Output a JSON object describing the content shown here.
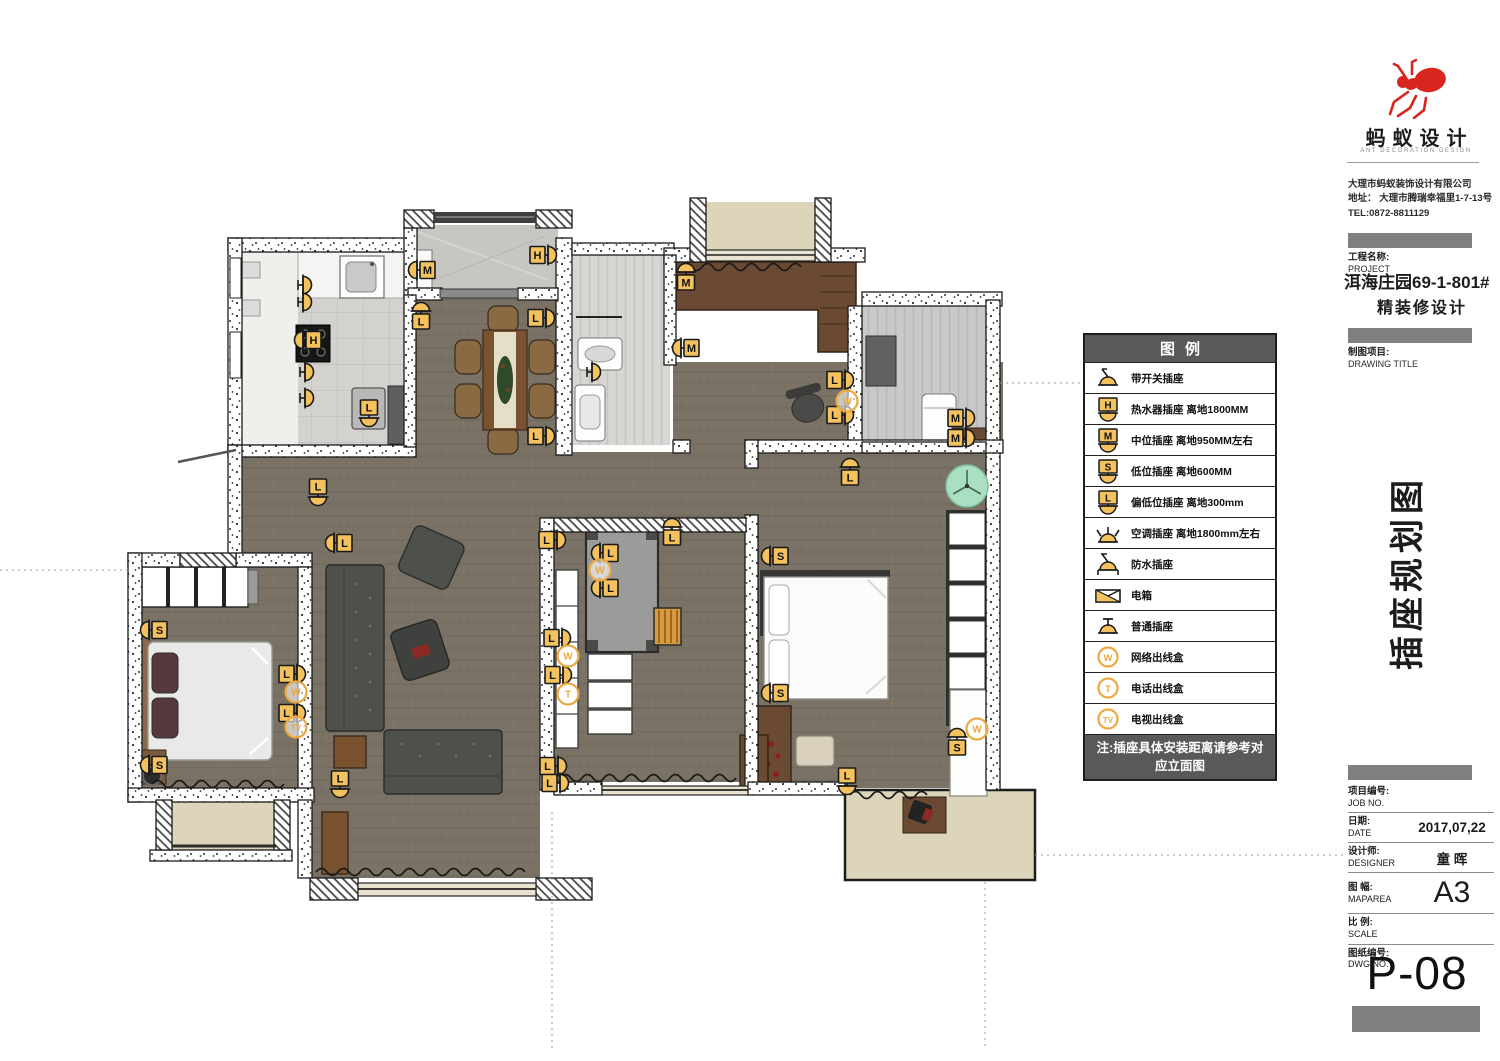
{
  "colors": {
    "accent_yellow": "#f3c25e",
    "outlet_orange": "#eca93f",
    "legend_header_bg": "#58595b",
    "brand_red": "#d9251d",
    "wood_floor": "#7b7266",
    "balcony_floor": "#ddd5b9",
    "left_bar_gray": "#737373"
  },
  "brand": {
    "name": "蚂蚁设计",
    "subtitle": "ANT DECORATION DESIGN",
    "company": "大理市蚂蚁装饰设计有限公司",
    "address": "地址： 大理市腾瑞幸福里1-7-13号",
    "tel": "TEL:0872-8811129"
  },
  "project": {
    "label_cn": "工程名称:",
    "label_en": "PROJECT",
    "name_line1": "洱海庄园69-1-801#",
    "name_line2": "精装修设计"
  },
  "drawing": {
    "label_cn": "制图项目:",
    "label_en": "DRAWING TITLE",
    "vertical_title": "插座规划图"
  },
  "legend": {
    "title": "图例",
    "items": [
      {
        "icon": "switch-socket",
        "label": "带开关插座"
      },
      {
        "icon": "letter-socket",
        "letter": "H",
        "label": "热水器插座 离地1800MM"
      },
      {
        "icon": "letter-socket",
        "letter": "M",
        "label": "中位插座  离地950MM左右"
      },
      {
        "icon": "letter-socket",
        "letter": "S",
        "label": "低位插座  离地600MM"
      },
      {
        "icon": "letter-socket",
        "letter": "L",
        "label": "偏低位插座 离地300mm"
      },
      {
        "icon": "ac-socket",
        "label": "空调插座 离地1800mm左右"
      },
      {
        "icon": "waterproof-socket",
        "label": "防水插座"
      },
      {
        "icon": "power-box",
        "label": "电箱"
      },
      {
        "icon": "normal-socket",
        "label": "普通插座"
      },
      {
        "icon": "circle-outlet",
        "letter": "W",
        "label": "网络出线盒"
      },
      {
        "icon": "circle-outlet",
        "letter": "T",
        "label": "电话出线盒"
      },
      {
        "icon": "circle-outlet",
        "letter": "TV",
        "label": "电视出线盒"
      }
    ],
    "note": "注:插座具体安装距离请参考对应立面图"
  },
  "titleblock": {
    "rows": [
      {
        "cn": "项目编号:",
        "en": "JOB NO.",
        "value": ""
      },
      {
        "cn": "日期:",
        "en": "DATE",
        "value": "2017,07,22"
      },
      {
        "cn": "设计师:",
        "en": "DESIGNER",
        "value": "童 晖"
      },
      {
        "cn": "图 幅:",
        "en": "MAPAREA",
        "value": "A3",
        "big": true
      },
      {
        "cn": "比 例:",
        "en": "SCALE",
        "value": ""
      },
      {
        "cn": "图纸编号:",
        "en": "DWG NO.",
        "value": ""
      }
    ],
    "sheet_no": "P-08"
  },
  "plan": {
    "sockets": [
      {
        "x": 303,
        "y": 285,
        "rot": 90
      },
      {
        "x": 303,
        "y": 302,
        "rot": 90
      },
      {
        "x": 303,
        "y": 340,
        "letter": "H",
        "rot": -90
      },
      {
        "x": 305,
        "y": 372,
        "rot": 90
      },
      {
        "x": 305,
        "y": 398,
        "rot": 90
      },
      {
        "x": 369,
        "y": 418,
        "letter": "L",
        "rot": 180
      },
      {
        "x": 417,
        "y": 270,
        "letter": "M",
        "rot": -90
      },
      {
        "x": 548,
        "y": 255,
        "letter": "H",
        "rot": 90
      },
      {
        "x": 421,
        "y": 311,
        "letter": "L",
        "rot": 0
      },
      {
        "x": 546,
        "y": 318,
        "letter": "L",
        "rot": 90
      },
      {
        "x": 546,
        "y": 436,
        "letter": "L",
        "rot": 90
      },
      {
        "x": 318,
        "y": 497,
        "letter": "L",
        "rot": 180
      },
      {
        "x": 592,
        "y": 372,
        "rot": 90
      },
      {
        "x": 686,
        "y": 272,
        "letter": "M",
        "rot": 0
      },
      {
        "x": 681,
        "y": 348,
        "letter": "M",
        "rot": -90
      },
      {
        "x": 845,
        "y": 380,
        "letter": "L",
        "rot": 90
      },
      {
        "x": 845,
        "y": 415,
        "letter": "L",
        "rot": 90
      },
      {
        "x": 966,
        "y": 418,
        "letter": "M",
        "rot": 90
      },
      {
        "x": 966,
        "y": 438,
        "letter": "M",
        "rot": 90
      },
      {
        "x": 850,
        "y": 467,
        "letter": "L",
        "rot": 0
      },
      {
        "x": 770,
        "y": 556,
        "letter": "S",
        "rot": -90
      },
      {
        "x": 770,
        "y": 693,
        "letter": "S",
        "rot": -90
      },
      {
        "x": 847,
        "y": 786,
        "letter": "L",
        "rot": 180
      },
      {
        "x": 957,
        "y": 737,
        "letter": "S",
        "rot": 0
      },
      {
        "x": 334,
        "y": 543,
        "letter": "L",
        "rot": -90
      },
      {
        "x": 557,
        "y": 540,
        "letter": "L",
        "rot": 90
      },
      {
        "x": 600,
        "y": 553,
        "letter": "L",
        "rot": -90
      },
      {
        "x": 600,
        "y": 588,
        "letter": "L",
        "rot": -90
      },
      {
        "x": 672,
        "y": 527,
        "letter": "L",
        "rot": 0
      },
      {
        "x": 562,
        "y": 638,
        "letter": "L",
        "rot": 90
      },
      {
        "x": 563,
        "y": 675,
        "letter": "L",
        "rot": 90
      },
      {
        "x": 558,
        "y": 766,
        "letter": "L",
        "rot": 90
      },
      {
        "x": 560,
        "y": 783,
        "letter": "L",
        "rot": 90
      },
      {
        "x": 149,
        "y": 630,
        "letter": "S",
        "rot": -90
      },
      {
        "x": 149,
        "y": 765,
        "letter": "S",
        "rot": -90
      },
      {
        "x": 297,
        "y": 674,
        "letter": "L",
        "rot": 90
      },
      {
        "x": 297,
        "y": 713,
        "letter": "L",
        "rot": 90
      },
      {
        "x": 340,
        "y": 789,
        "letter": "L",
        "rot": 180
      }
    ],
    "outlets": [
      {
        "x": 847,
        "y": 401,
        "t": "W"
      },
      {
        "x": 600,
        "y": 570,
        "t": "W"
      },
      {
        "x": 296,
        "y": 692,
        "t": "W"
      },
      {
        "x": 568,
        "y": 656,
        "t": "W"
      },
      {
        "x": 568,
        "y": 694,
        "t": "T"
      },
      {
        "x": 977,
        "y": 729,
        "t": "W"
      },
      {
        "x": 296,
        "y": 727,
        "t": "TV"
      }
    ],
    "fan": {
      "x": 967,
      "y": 486
    }
  }
}
